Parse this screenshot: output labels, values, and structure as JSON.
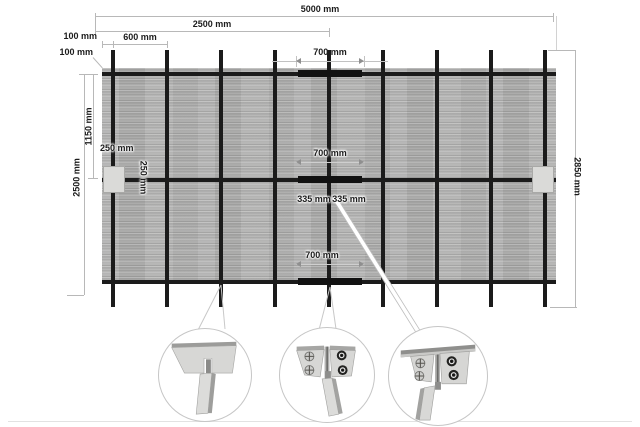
{
  "dims": {
    "w5000": "5000 mm",
    "w2500": "2500 mm",
    "w100_top": "100 mm",
    "w600": "600 mm",
    "h100_left": "100 mm",
    "h1150": "1150 mm",
    "h2500": "2500 mm",
    "w250_bracket": "250 mm",
    "h250_bracket": "250 mm",
    "w700_top": "700 mm",
    "w700_middle": "700 mm",
    "w700_bottom": "700 mm",
    "w335_left": "335 mm",
    "w335_right": "335 mm",
    "h2850": "2850 mm"
  },
  "icons": {
    "detail_left": "rail-post-slot-rear-view",
    "detail_middle": "rail-post-bracket-screws-front-view",
    "detail_right": "rail-post-bracket-screws-angled-view"
  },
  "colors": {
    "background": "#ffffff",
    "panel_gray": "#b3b3b2",
    "frame_black": "#1b1b1b",
    "dim_line_gray": "#b8b8b8",
    "bracket_fill": "#dadad8"
  }
}
